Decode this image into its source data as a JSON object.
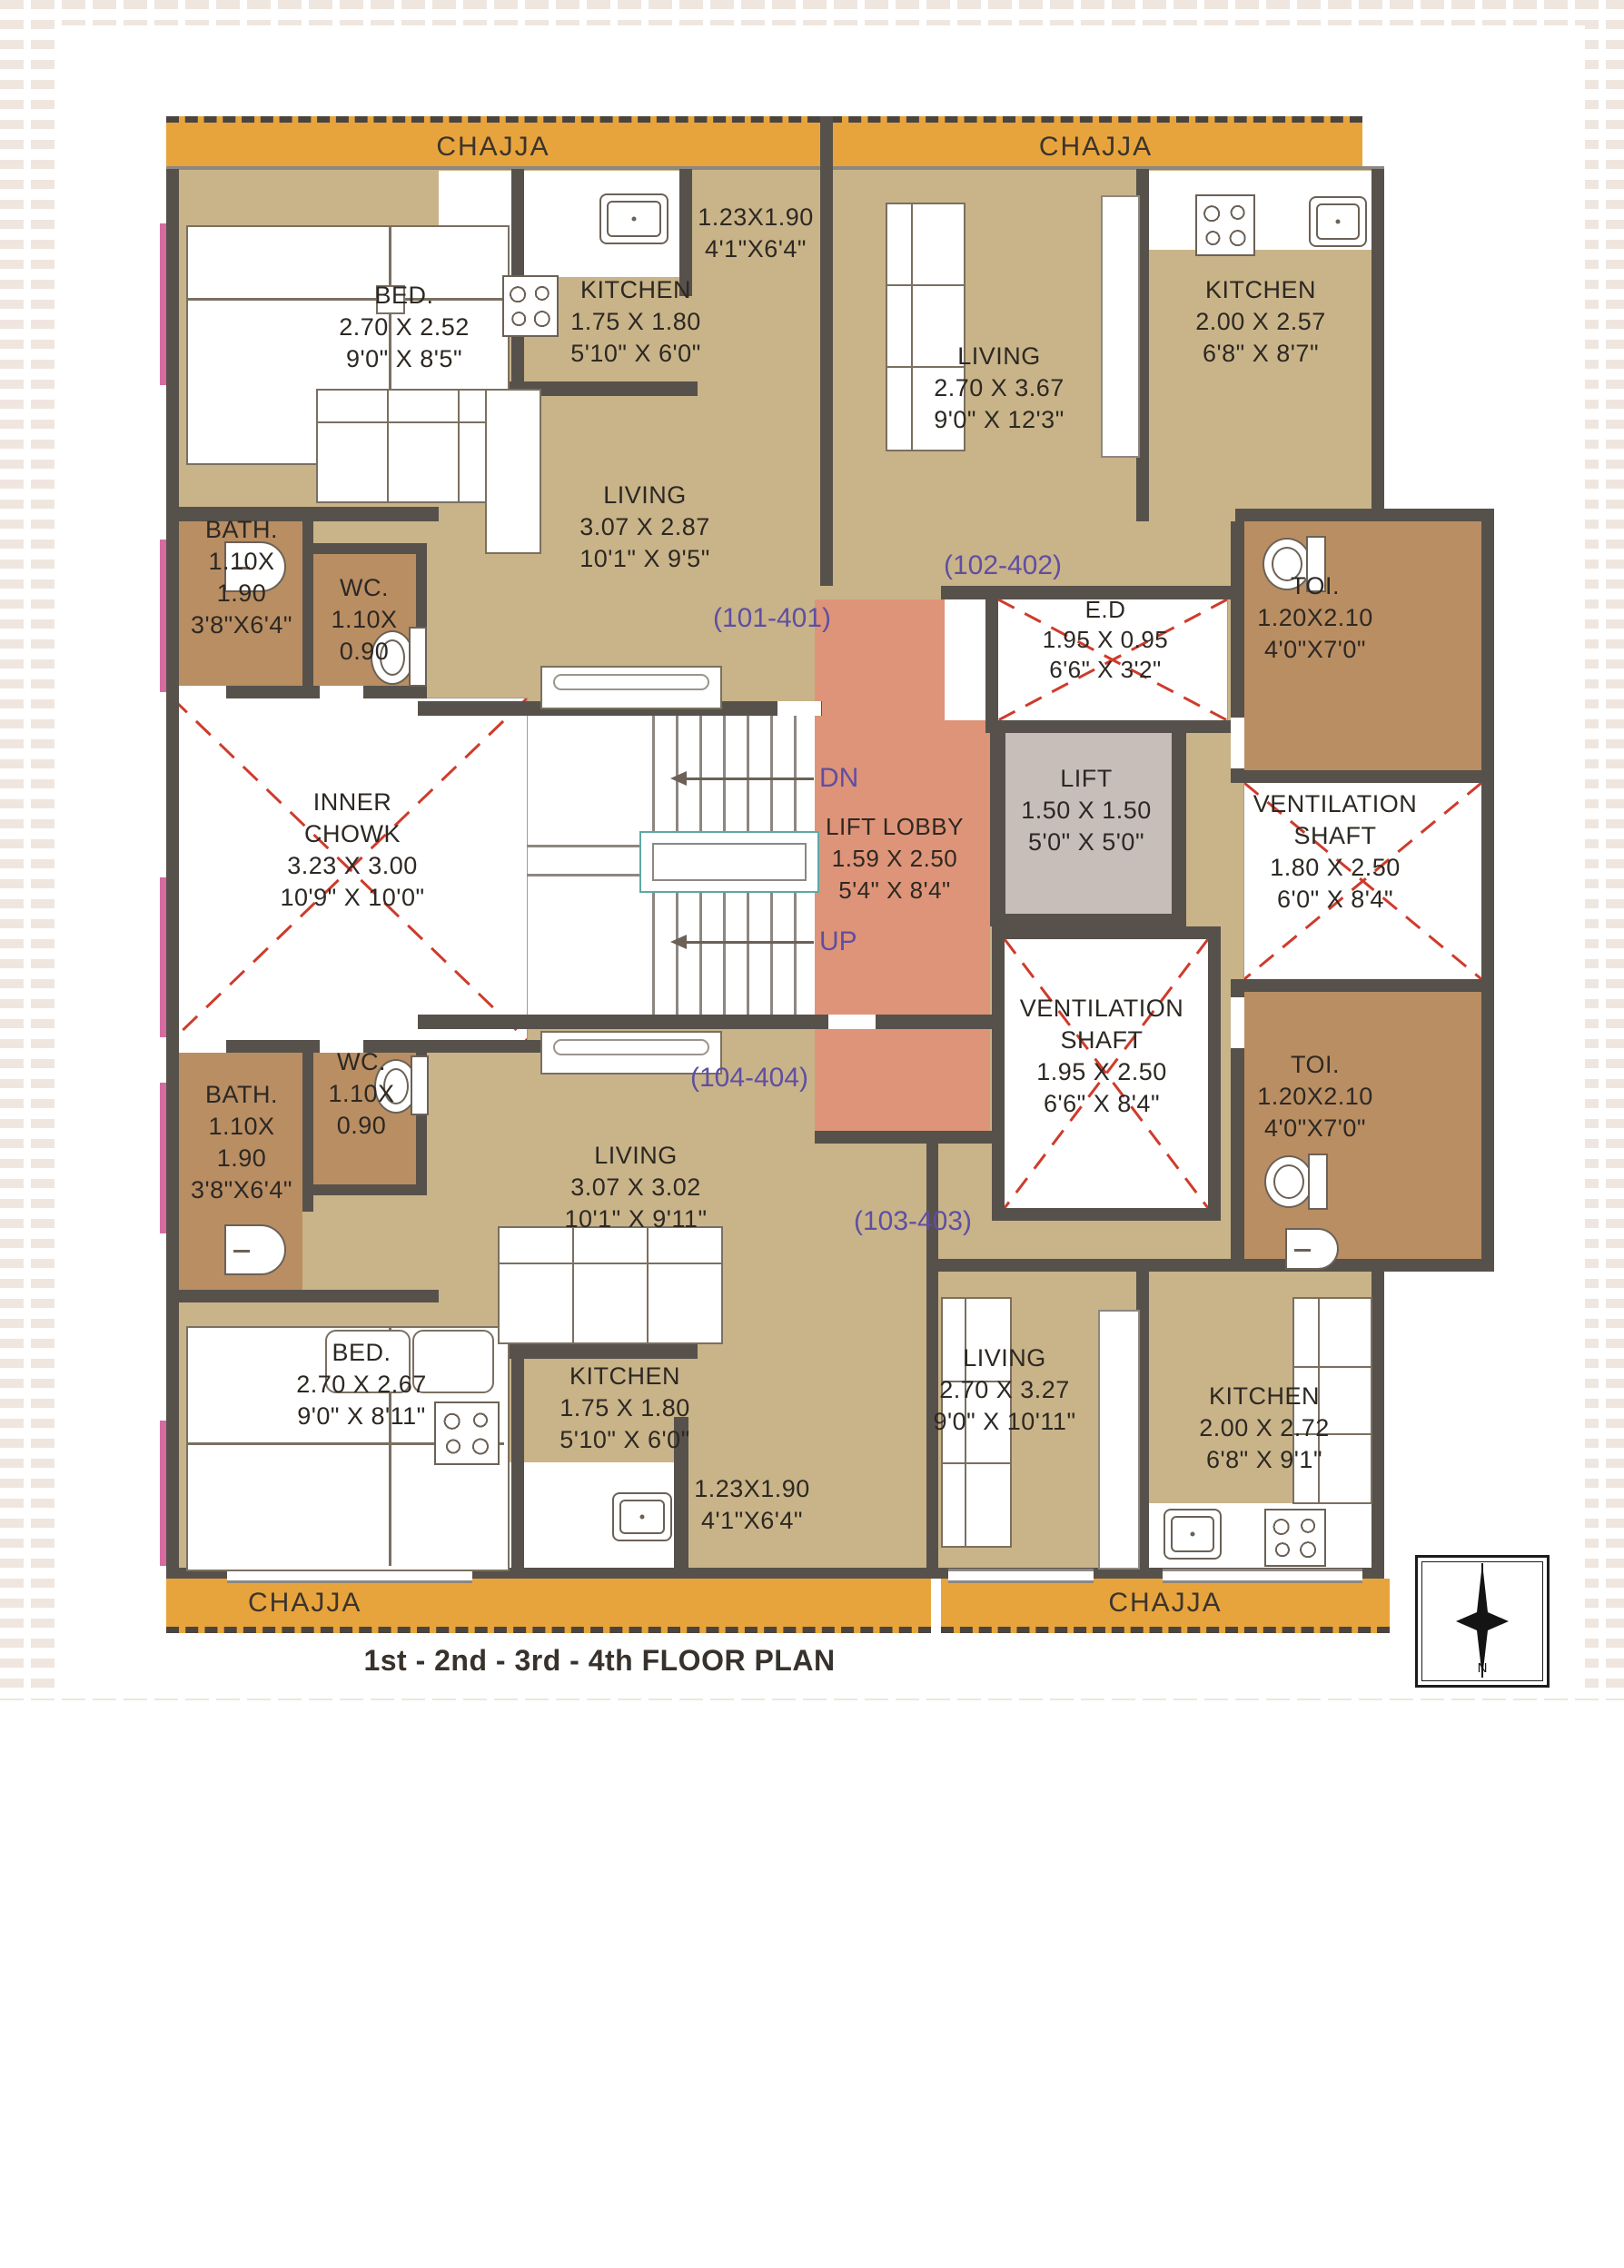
{
  "title": "1st - 2nd - 3rd - 4th FLOOR PLAN",
  "chajja_label": "CHAJJA",
  "compass": {
    "north_letter": "N"
  },
  "stairs": {
    "down_label": "DN",
    "up_label": "UP"
  },
  "unit_ids": {
    "tl": "(101-401)",
    "tr": "(102-402)",
    "br": "(103-403)",
    "bl": "(104-404)"
  },
  "rooms": {
    "tl_bed": {
      "lines": [
        "BED.",
        "2.70 X 2.52",
        "9'0\" X 8'5\""
      ]
    },
    "tl_kitchen": {
      "lines": [
        "KITCHEN",
        "1.75 X 1.80",
        "5'10\" X 6'0\""
      ]
    },
    "tl_flowerbed": {
      "lines": [
        "1.23X1.90",
        "4'1\"X6'4\""
      ]
    },
    "tl_living": {
      "lines": [
        "LIVING",
        "3.07 X 2.87",
        "10'1\" X 9'5\""
      ]
    },
    "tl_bath": {
      "lines": [
        "BATH.",
        "1.10X",
        "1.90",
        "3'8\"X6'4\""
      ]
    },
    "tl_wc": {
      "lines": [
        "WC.",
        "1.10X",
        "0.90"
      ]
    },
    "inner_chowk": {
      "lines": [
        "INNER",
        "CHOWK",
        "3.23 X 3.00",
        "10'9\" X 10'0\""
      ]
    },
    "lift_lobby": {
      "lines": [
        "LIFT LOBBY",
        "1.59 X 2.50",
        "5'4\" X 8'4\""
      ]
    },
    "lift": {
      "lines": [
        "LIFT",
        "1.50 X 1.50",
        "5'0\" X 5'0\""
      ]
    },
    "ed": {
      "lines": [
        "E.D",
        "1.95 X 0.95",
        "6'6\" X 3'2\""
      ]
    },
    "tr_living": {
      "lines": [
        "LIVING",
        "2.70 X 3.67",
        "9'0\" X 12'3\""
      ]
    },
    "tr_kitchen": {
      "lines": [
        "KITCHEN",
        "2.00 X 2.57",
        "6'8\" X 8'7\""
      ]
    },
    "toi_top": {
      "lines": [
        "TOI.",
        "1.20X2.10",
        "4'0\"X7'0\""
      ]
    },
    "vent_shaft_top": {
      "lines": [
        "VENTILATION",
        "SHAFT",
        "1.80 X 2.50",
        "6'0\" X 8'4\""
      ]
    },
    "vent_shaft_bottom": {
      "lines": [
        "VENTILATION",
        "SHAFT",
        "1.95 X 2.50",
        "6'6\" X 8'4\""
      ]
    },
    "toi_bottom": {
      "lines": [
        "TOI.",
        "1.20X2.10",
        "4'0\"X7'0\""
      ]
    },
    "bl_bath": {
      "lines": [
        "BATH.",
        "1.10X",
        "1.90",
        "3'8\"X6'4\""
      ]
    },
    "bl_wc": {
      "lines": [
        "WC.",
        "1.10X",
        "0.90"
      ]
    },
    "bl_living": {
      "lines": [
        "LIVING",
        "3.07 X 3.02",
        "10'1\" X 9'11\""
      ]
    },
    "bl_bed": {
      "lines": [
        "BED.",
        "2.70 X 2.67",
        "9'0\" X 8'11\""
      ]
    },
    "bl_kitchen": {
      "lines": [
        "KITCHEN",
        "1.75 X 1.80",
        "5'10\" X 6'0\""
      ]
    },
    "bl_flowerbed": {
      "lines": [
        "1.23X1.90",
        "4'1\"X6'4\""
      ]
    },
    "br_living": {
      "lines": [
        "LIVING",
        "2.70 X 3.27",
        "9'0\" X 10'11\""
      ]
    },
    "br_kitchen": {
      "lines": [
        "KITCHEN",
        "2.00 X 2.72",
        "6'8\" X 9'1\""
      ]
    }
  },
  "colors": {
    "chajja": "#e8a43c",
    "floor": "#c9b489",
    "wet_room": "#b98e63",
    "lift_lobby": "#de9478",
    "lift": "#c7beba",
    "wall": "#57514b",
    "cross_marker": "#cf3b2b",
    "unit_number_text": "#5f4ea3",
    "rail": "#5fa8a4"
  }
}
